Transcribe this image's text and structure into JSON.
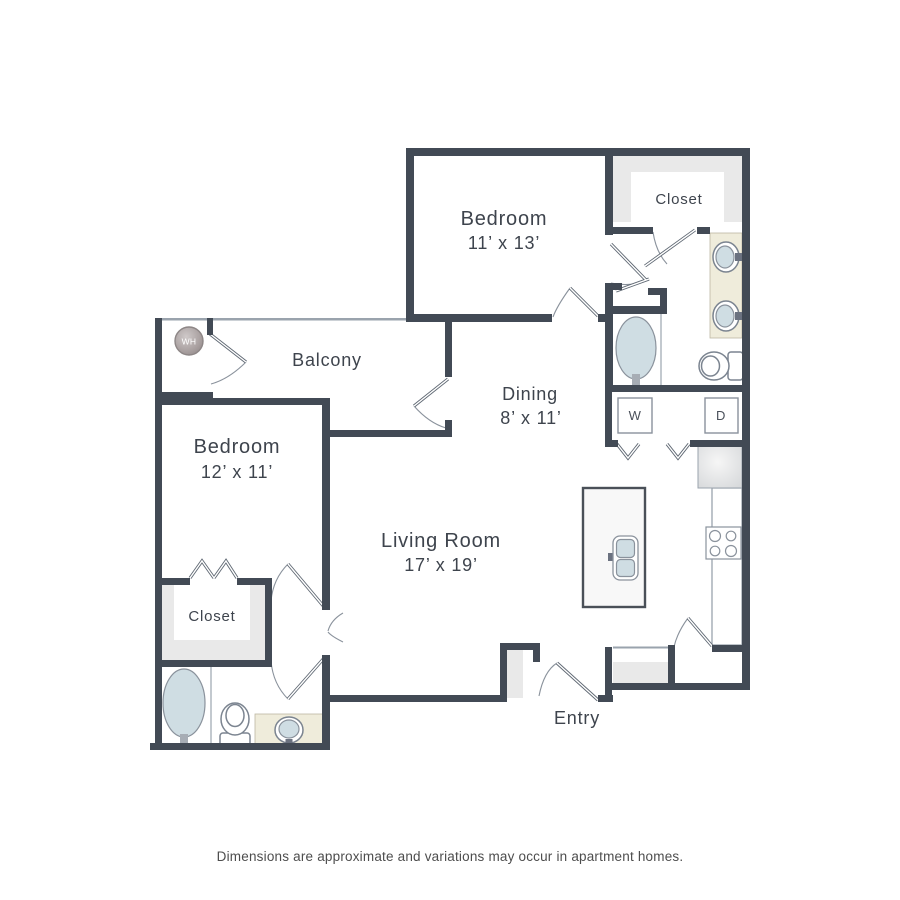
{
  "plan": {
    "title_hidden": "",
    "rooms": {
      "bedroom1_name": "Bedroom",
      "bedroom1_dims": "11’ x 13’",
      "bedroom2_name": "Bedroom",
      "bedroom2_dims": "12’ x 11’",
      "living_name": "Living Room",
      "living_dims": "17’ x 19’",
      "dining_name": "Dining",
      "dining_dims": "8’ x 11’",
      "balcony": "Balcony",
      "entry": "Entry",
      "closet_upper": "Closet",
      "closet_lower": "Closet"
    },
    "appliances": {
      "washer": "W",
      "dryer": "D",
      "water_heater": "WH"
    },
    "disclaimer": "Dimensions are approximate and variations may occur in apartment homes.",
    "colors": {
      "wall": "#424a55",
      "water_fixture": "#cfdde3",
      "vanity": "#efecdb",
      "shelving": "#e9e9e9",
      "label_text": "#3e444d"
    }
  }
}
